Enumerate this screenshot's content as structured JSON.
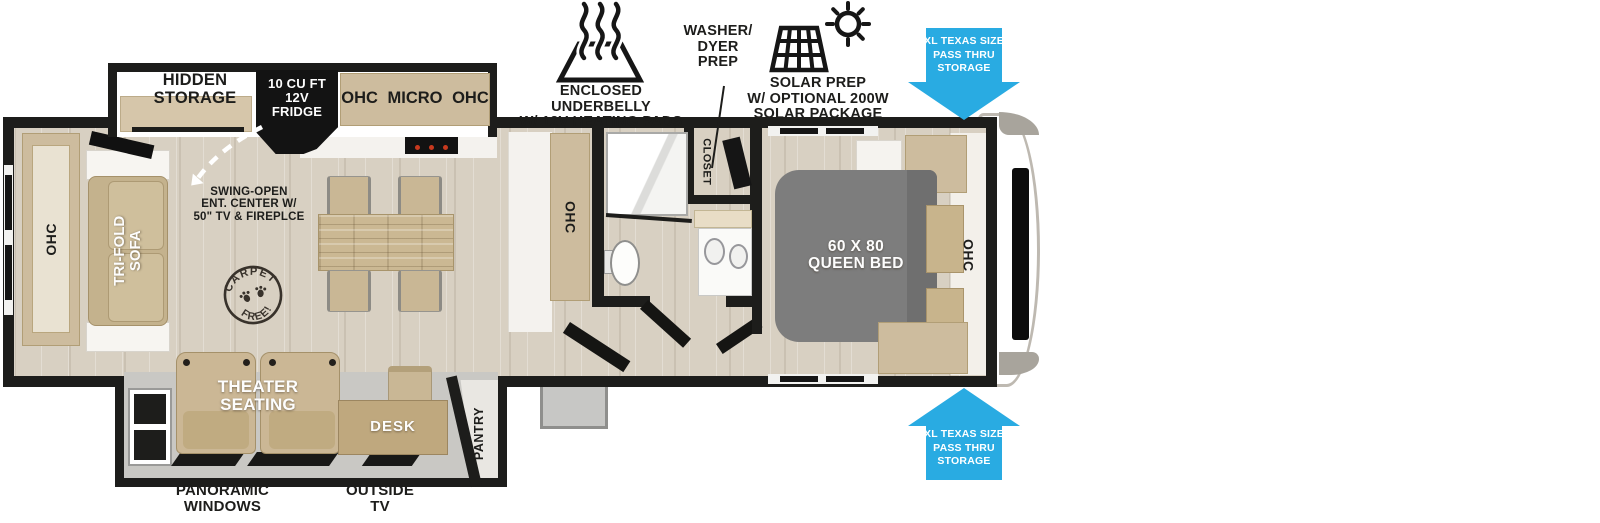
{
  "colors": {
    "accent_blue": "#29abe2",
    "wall_black": "#1d1d1b",
    "floor_tan": "#d8d0c2",
    "cabinet_tan": "#cdbc9e",
    "bed_gray": "#7d7d7d"
  },
  "top_annotations": {
    "underbelly_label": "ENCLOSED UNDERBELLY\nW/ 12V HEATING PADS",
    "washer_dryer_label": "WASHER/\nDYER\nPREP",
    "solar_label": "SOLAR PREP\nW/ OPTIONAL 200W\nSOLAR PACKAGE",
    "pass_thru_storage_top": "XL TEXAS SIZE\nPASS THRU\nSTORAGE",
    "pass_thru_storage_bottom": "XL TEXAS SIZE\nPASS THRU\nSTORAGE"
  },
  "floorplan": {
    "hidden_storage": "HIDDEN\nSTORAGE",
    "fridge": "10 CU FT\n12V\nFRIDGE",
    "kitchen_overhead": "OHC MICRO OHC",
    "kitchen_ohc": "OHC",
    "rear_ohc": "OHC",
    "bedroom_ohc": "OHC",
    "closet": "CLOSET",
    "queen_bed": "60 X 80\nQUEEN BED",
    "tri_fold_sofa": "TRI-FOLD\nSOFA",
    "ent_center": "SWING-OPEN\nENT. CENTER W/\n50\" TV & FIREPLCE",
    "carpet_stamp_top": "CARPET",
    "carpet_stamp_bottom": "FREE!",
    "theater_seating": "THEATER\nSEATING",
    "desk": "DESK",
    "pantry": "PANTRY"
  },
  "captions": {
    "panoramic_windows": "PANORAMIC\nWINDOWS",
    "outside_tv": "OUTSIDE\nTV"
  }
}
